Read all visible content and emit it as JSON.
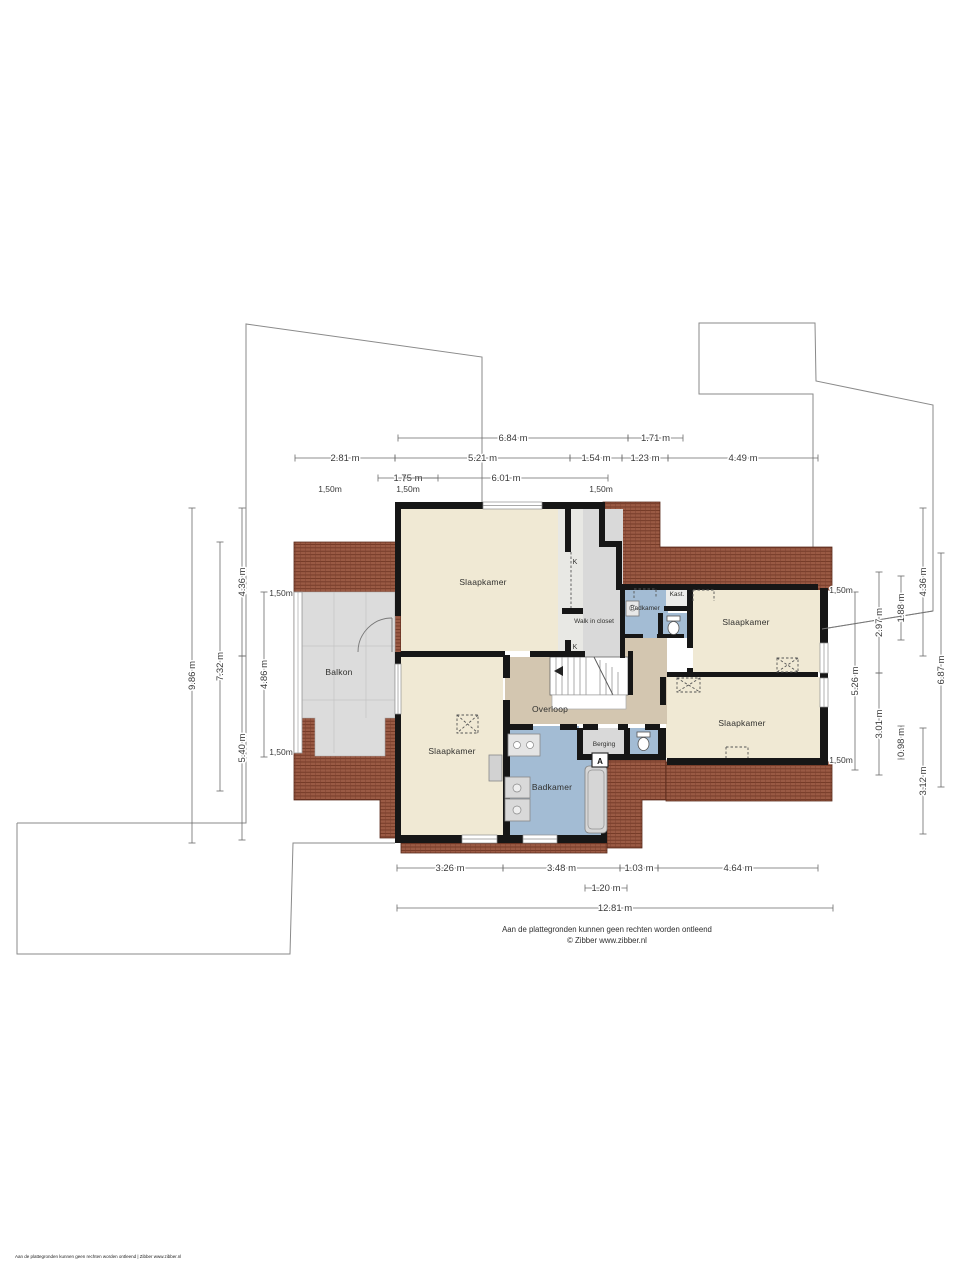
{
  "title": "Floor plan - first floor (verdieping)",
  "rooms": {
    "slaapkamer_tl": "Slaapkamer",
    "slaapkamer_bl": "Slaapkamer",
    "slaapkamer_tr": "Slaapkamer",
    "slaapkamer_br": "Slaapkamer",
    "walk_in_closet": "Walk in closet",
    "badkamer_top": "Badkamer",
    "badkamer_bottom": "Badkamer",
    "kast": "Kast.",
    "berging": "Berging",
    "balkon": "Balkon",
    "overloop": "Overloop",
    "k1": "K",
    "k2": "K",
    "berging_marker": "A"
  },
  "dimensions": {
    "top": [
      "6.84 m",
      "1.71 m",
      "2.81 m",
      "5.21 m",
      "1.54 m",
      "1.23 m",
      "4.49 m",
      "1.75 m",
      "6.01 m"
    ],
    "bottom": [
      "3.26 m",
      "3.48 m",
      "1.03 m",
      "4.64 m",
      "1.20 m",
      "12.81 m"
    ],
    "left": [
      "9.86 m",
      "7.32 m",
      "4.36 m",
      "5.40 m",
      "4.86 m"
    ],
    "right": [
      "5.26 m",
      "2.97 m",
      "3.01 m",
      "1.88 m",
      "0.98 m",
      "4.36 m",
      "3.12 m",
      "6.87 m"
    ],
    "marks": [
      "1,50m",
      "1,50m",
      "1,50m",
      "1,50m",
      "1,50m",
      "1,50m",
      "1,50m"
    ]
  },
  "footer": {
    "disclaimer": "Aan de plattegronden kunnen geen rechten worden ontleend",
    "credit": "© Zibber www.zibber.nl",
    "corner": "Aan de plattegronden kunnen geen rechten worden ontleend | Zibber www.zibber.nl"
  },
  "colors": {
    "room": "#f0e9d4",
    "hall": "#d3c6b0",
    "wet": "#a3bcd4",
    "closet": "#dadada",
    "balcony": "#dcdcdc",
    "roof": "#9a5a44",
    "wall": "#161616"
  }
}
